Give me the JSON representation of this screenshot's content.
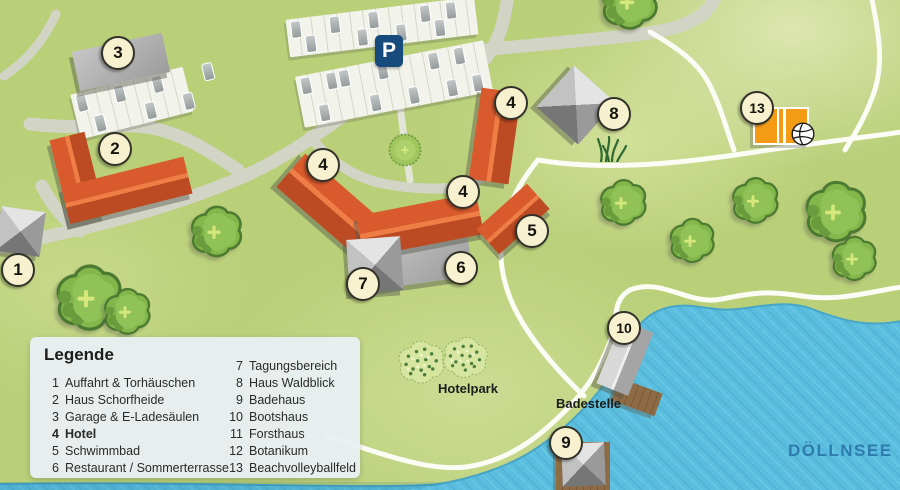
{
  "legend": {
    "title": "Legende",
    "col1": [
      {
        "num": "1",
        "label": "Auffahrt & Torhäuschen"
      },
      {
        "num": "2",
        "label": "Haus Schorfheide"
      },
      {
        "num": "3",
        "label": "Garage & E-Ladesäulen"
      },
      {
        "num": "4",
        "label": "Hotel"
      },
      {
        "num": "5",
        "label": "Schwimmbad"
      },
      {
        "num": "6",
        "label": "Restaurant / Sommerterrasse"
      }
    ],
    "col2": [
      {
        "num": "7",
        "label": "Tagungsbereich"
      },
      {
        "num": "8",
        "label": "Haus Waldblick"
      },
      {
        "num": "9",
        "label": "Badehaus"
      },
      {
        "num": "10",
        "label": "Bootshaus"
      },
      {
        "num": "11",
        "label": "Forsthaus"
      },
      {
        "num": "12",
        "label": "Botanikum"
      },
      {
        "num": "13",
        "label": "Beachvolleyballfeld"
      }
    ]
  },
  "map_labels": {
    "lake": "DÖLLNSEE",
    "park": "Hotelpark",
    "bathing": "Badestelle",
    "parking_sign": "P"
  },
  "markers": {
    "m1": "1",
    "m2": "2",
    "m3": "3",
    "m4a": "4",
    "m4b": "4",
    "m4c": "4",
    "m5": "5",
    "m6": "6",
    "m7": "7",
    "m8": "8",
    "m9": "9",
    "m10": "10",
    "m13": "13"
  },
  "colors": {
    "grass": "#b9cf78",
    "roof_red": "#d2552a",
    "building_gray": "#a9a9a9",
    "road": "#d2d4c6",
    "path_white": "#fbfcf4",
    "lake": "#5cbede",
    "lake_label": "#2e7cae",
    "marker_cream": "#f7f1cf",
    "parking_sign_blue": "#174a7d",
    "volleyball_orange": "#f49c16",
    "deck_brown": "#8d6c45"
  }
}
